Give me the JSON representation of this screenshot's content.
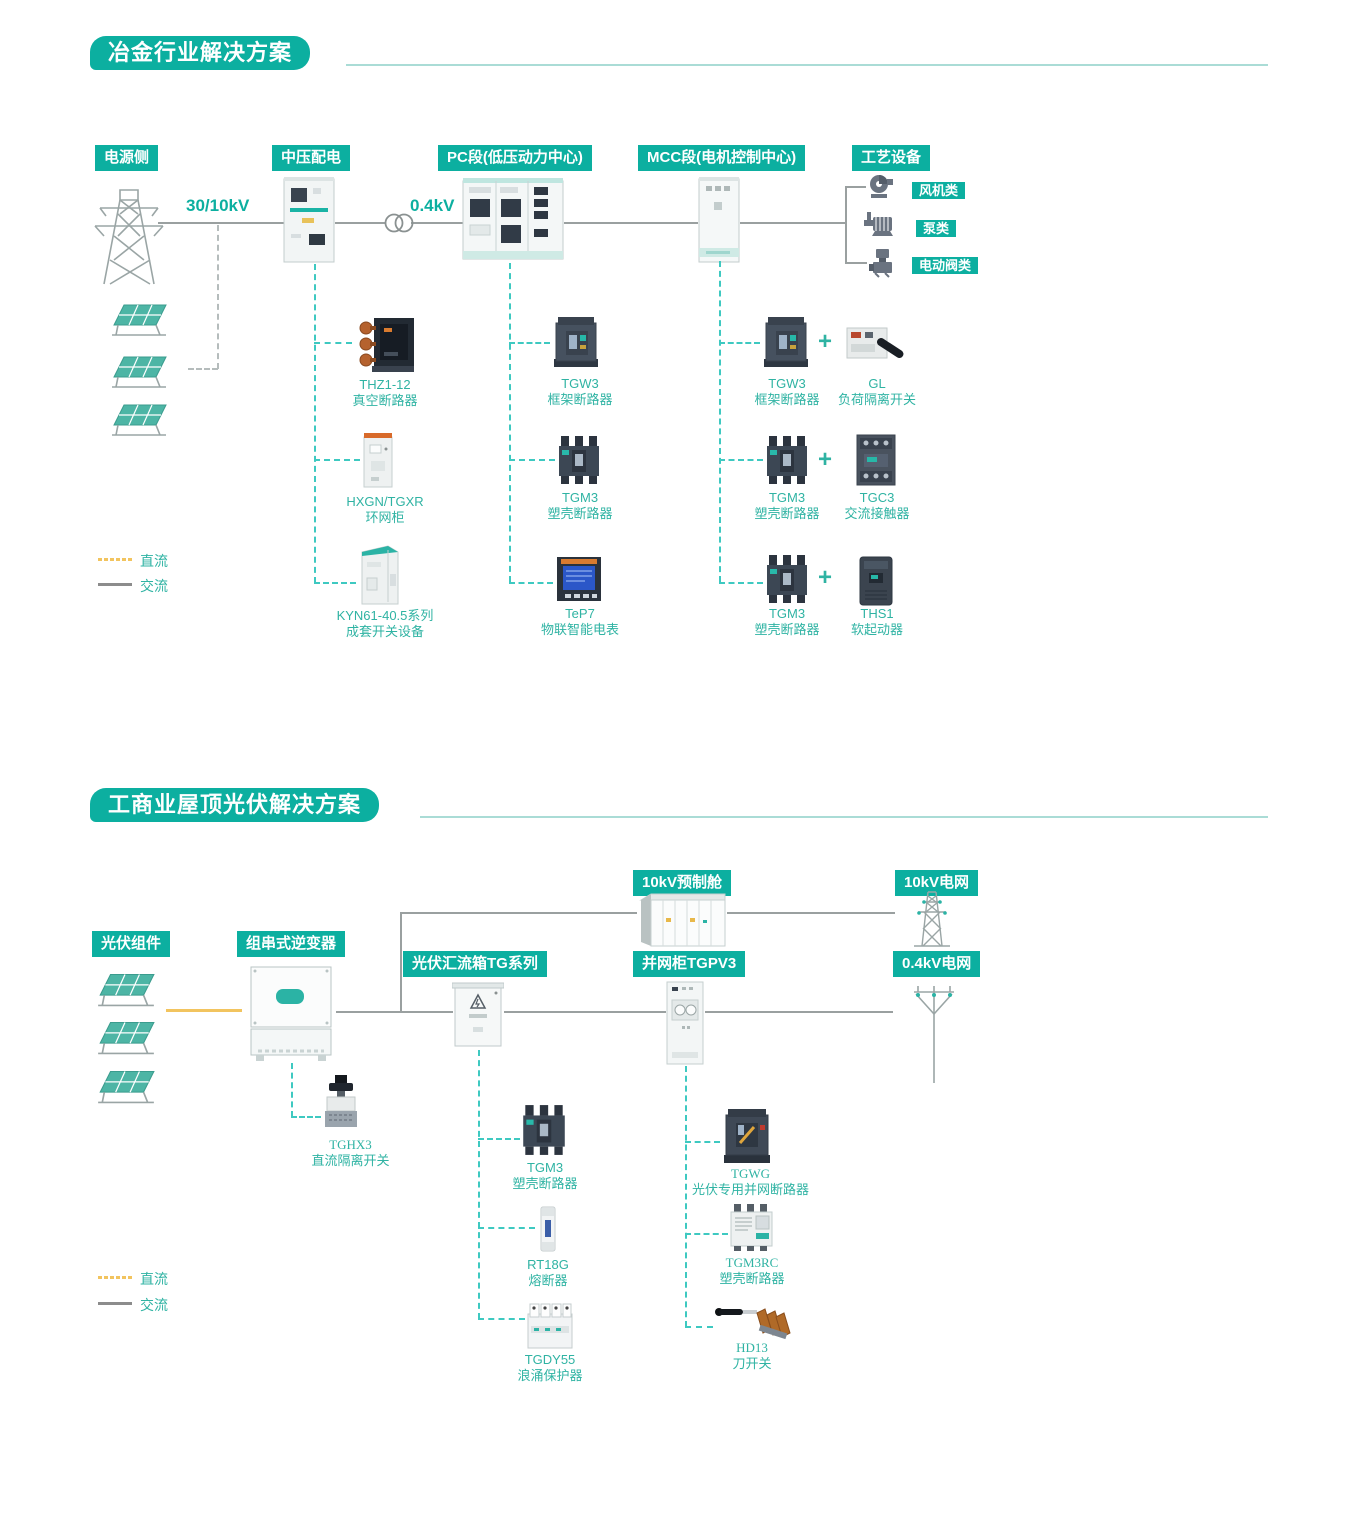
{
  "colors": {
    "teal_header": "#0CAFA0",
    "teal_text": "#2FB3A3",
    "teal_dash": "#3EC9C1",
    "gray_line": "#9AA0A0",
    "dc_yellow": "#F2C45F",
    "ac_gray": "#8C8C8C"
  },
  "legend": {
    "dc": "直流",
    "ac": "交流"
  },
  "section1": {
    "title": "冶金行业解决方案",
    "headers": {
      "power": "电源侧",
      "mv": "中压配电",
      "pc": "PC段(低压动力中心)",
      "mcc": "MCC段(电机控制中心)",
      "process": "工艺设备"
    },
    "voltage_in": "30/10kV",
    "voltage_lv": "0.4kV",
    "process_items": [
      {
        "label": "风机类"
      },
      {
        "label": "泵类"
      },
      {
        "label": "电动阀类"
      }
    ],
    "products_mv": [
      {
        "model": "THZ1-12",
        "desc": "真空断路器"
      },
      {
        "model": "HXGN/TGXR",
        "desc": "环网柜"
      },
      {
        "model": "KYN61-40.5系列",
        "desc": "成套开关设备"
      }
    ],
    "products_pc": [
      {
        "model": "TGW3",
        "desc": "框架断路器"
      },
      {
        "model": "TGM3",
        "desc": "塑壳断路器"
      },
      {
        "model": "TeP7",
        "desc": "物联智能电表"
      }
    ],
    "products_mcc": [
      {
        "model": "TGW3",
        "desc": "框架断路器",
        "plus": "+",
        "model2": "GL",
        "desc2": "负荷隔离开关"
      },
      {
        "model": "TGM3",
        "desc": "塑壳断路器",
        "plus": "+",
        "model2": "TGC3",
        "desc2": "交流接触器"
      },
      {
        "model": "TGM3",
        "desc": "塑壳断路器",
        "plus": "+",
        "model2": "THS1",
        "desc2": "软起动器"
      }
    ]
  },
  "section2": {
    "title": "工商业屋顶光伏解决方案",
    "headers": {
      "pv_modules": "光伏组件",
      "inverter": "组串式逆变器",
      "combiner": "光伏汇流箱TG系列",
      "grid_cabinet": "并网柜TGPV3",
      "prefab_cabin": "10kV预制舱",
      "grid_10kv": "10kV电网",
      "grid_04kv": "0.4kV电网"
    },
    "inverter_product": {
      "model": "TGHX3",
      "desc": "直流隔离开关"
    },
    "combiner_products": [
      {
        "model": "TGM3",
        "desc": "塑壳断路器"
      },
      {
        "model": "RT18G",
        "desc": "熔断器"
      },
      {
        "model": "TGDY55",
        "desc": "浪涌保护器"
      }
    ],
    "grid_products": [
      {
        "model": "TGWG",
        "desc": "光伏专用并网断路器"
      },
      {
        "model": "TGM3RC",
        "desc": "塑壳断路器"
      },
      {
        "model": "HD13",
        "desc": "刀开关"
      }
    ]
  }
}
